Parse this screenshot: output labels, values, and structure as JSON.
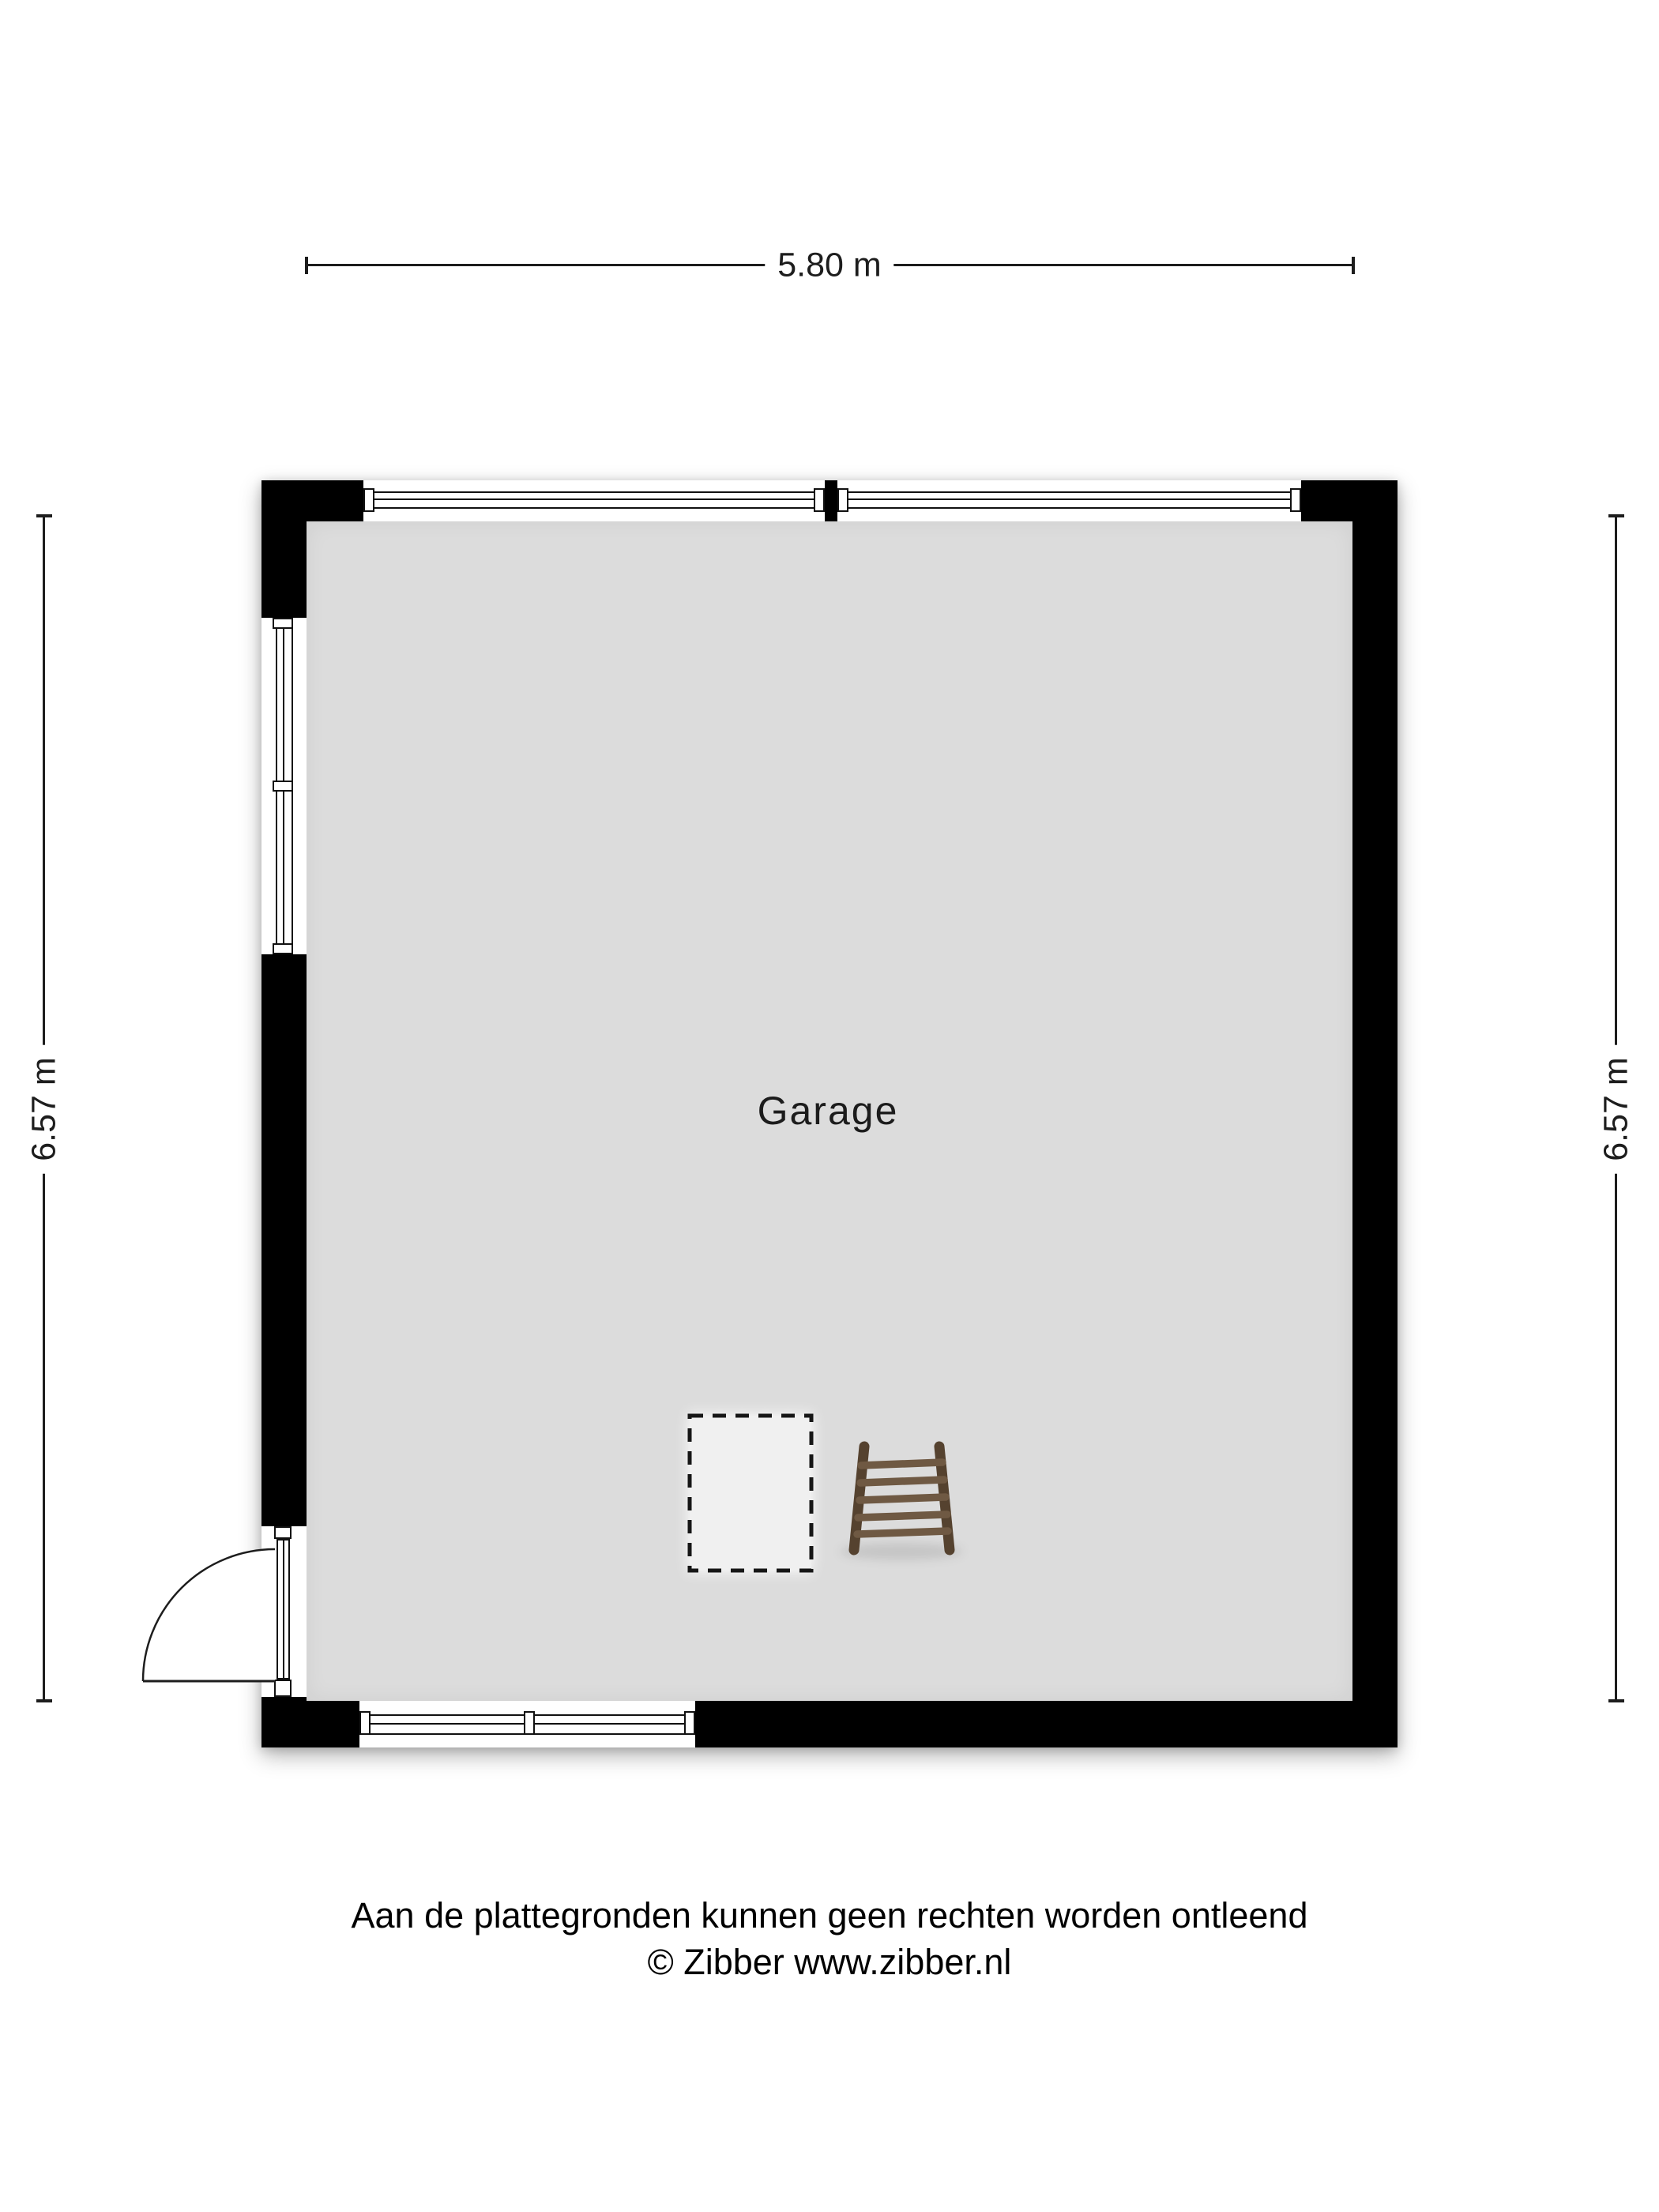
{
  "dimensions": {
    "top": {
      "label": "5.80 m"
    },
    "left": {
      "label": "6.57 m"
    },
    "right": {
      "label": "6.57 m"
    }
  },
  "rooms": [
    {
      "label": "Garage"
    }
  ],
  "footer": {
    "disclaimer": "Aan de plattegronden kunnen geen rechten worden ontleend",
    "copyright": "© Zibber www.zibber.nl"
  },
  "colors": {
    "wall": "#000000",
    "floor": "#dcdcdc",
    "line": "#1d1d1d",
    "window_frame": "#111111",
    "dashed_fill": "#f0f0f0",
    "ladder_rail": "#55422f",
    "ladder_rung": "#6f5943"
  }
}
